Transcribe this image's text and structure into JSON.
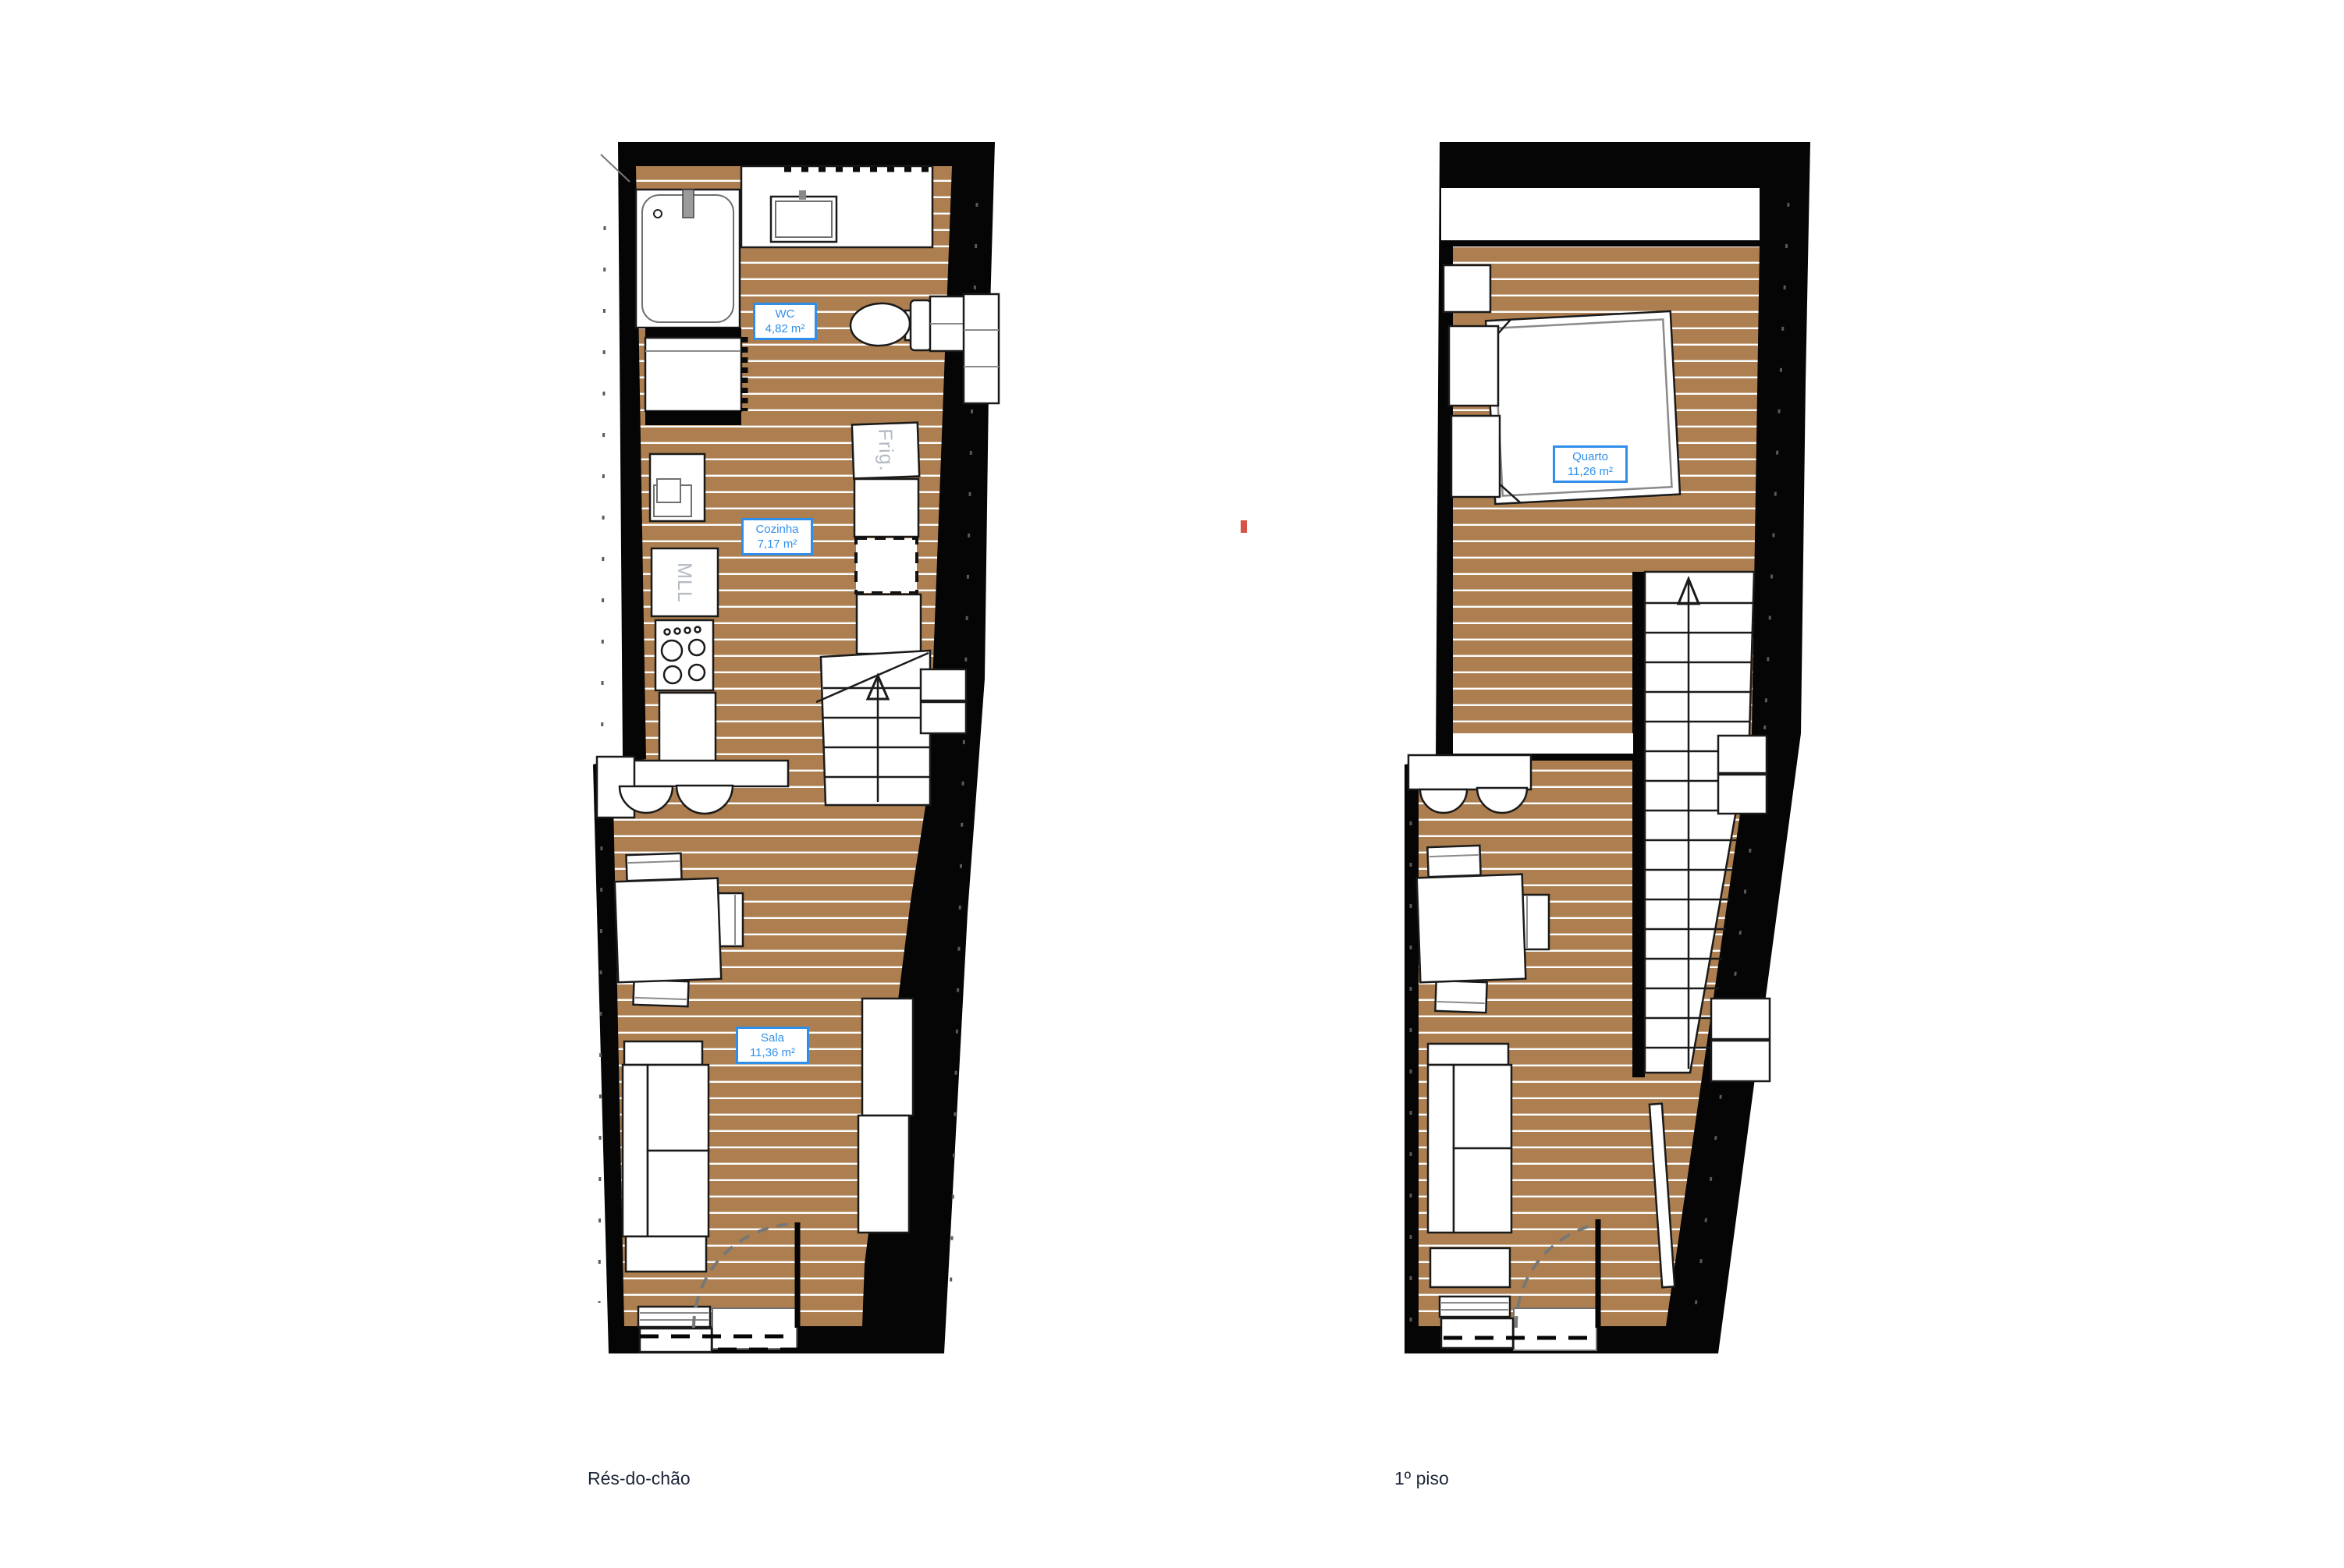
{
  "plans": [
    {
      "id": "ground-floor",
      "caption": "Rés-do-chão",
      "rooms": [
        {
          "name": "WC",
          "area": "4,82 m²"
        },
        {
          "name": "Cozinha",
          "area": "7,17 m²"
        },
        {
          "name": "Sala",
          "area": "11,36 m²"
        }
      ],
      "appliances": {
        "dishwasher": "MLL",
        "fridge": "Frig."
      }
    },
    {
      "id": "first-floor",
      "caption": "1º piso",
      "rooms": [
        {
          "name": "Quarto",
          "area": "11,26 m²"
        }
      ]
    }
  ],
  "colors": {
    "wall": "#050505",
    "floor_wood": "#ad7f50",
    "plank_line": "#ffffff",
    "label_blue": "#2f8fea",
    "caption_navy": "#1d2639",
    "appliance_gray": "#b4bac4",
    "artifact_red": "#d65348"
  }
}
